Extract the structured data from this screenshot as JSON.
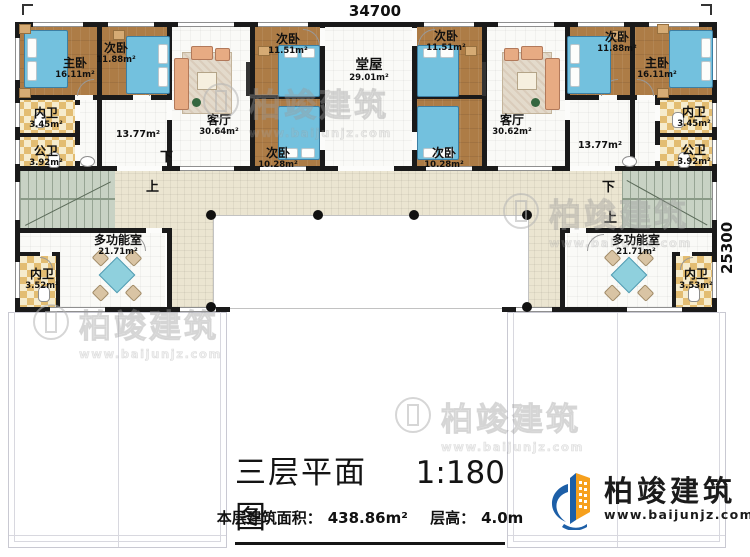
{
  "dimensions": {
    "width": "34700",
    "depth": "25300"
  },
  "stairs": {
    "up": "上",
    "down": "下"
  },
  "rooms": {
    "master": {
      "name": "主卧",
      "area": "16.11m²"
    },
    "bed_1188": {
      "name": "次卧",
      "area": "11.88m²"
    },
    "bed_1151": {
      "name": "次卧",
      "area": "11.51m²"
    },
    "bed_1028": {
      "name": "次卧",
      "area": "10.28m²"
    },
    "tangwu": {
      "name": "堂屋",
      "area": "29.01m²"
    },
    "living_left": {
      "name": "客厅",
      "area": "30.64m²"
    },
    "living_right": {
      "name": "客厅",
      "area": "30.62m²"
    },
    "inner_bath": {
      "name": "内卫",
      "area": "3.45m²"
    },
    "public_bath": {
      "name": "公卫",
      "area": "3.92m²"
    },
    "corridor": {
      "area": "13.77m²"
    },
    "multi": {
      "name": "多功能室",
      "area": "21.71m²"
    },
    "wing_bath_left": {
      "name": "内卫",
      "area": "3.52m²"
    },
    "wing_bath_right": {
      "name": "内卫",
      "area": "3.53m²"
    }
  },
  "title": {
    "text": "三层平面图",
    "scale": "1:180",
    "area_label": "本层建筑面积：",
    "area_value": "438.86m²",
    "height_label": "层高：",
    "height_value": "4.0m"
  },
  "brand": {
    "name": "柏竣建筑",
    "website": "www.baijunjz.com",
    "blue": "#1d5fa7",
    "orange": "#f6a01d"
  },
  "watermark": {
    "brand": "柏竣建筑",
    "website": "www.baijunjz.com"
  }
}
